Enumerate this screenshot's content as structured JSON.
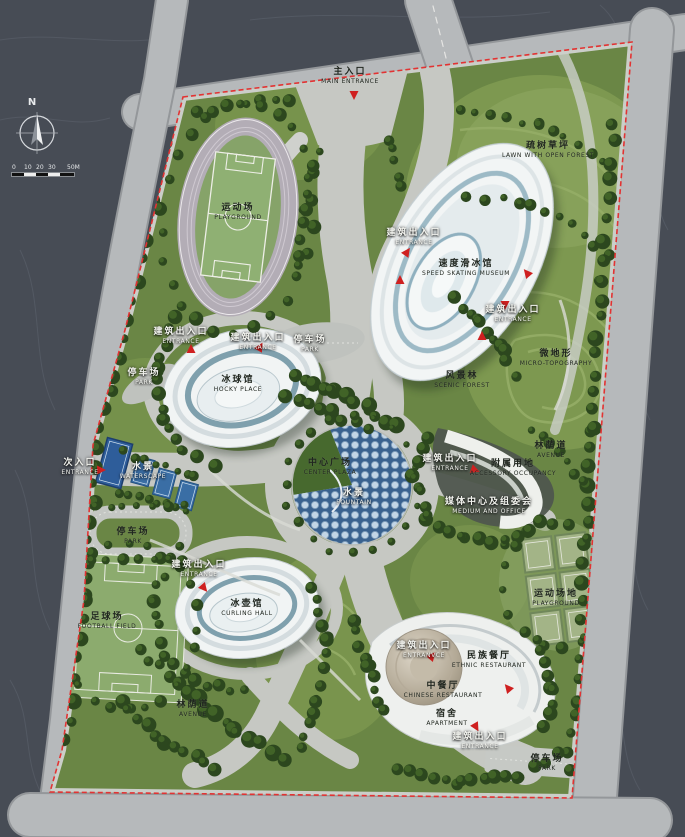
{
  "compass": {
    "north_label": "N"
  },
  "scale_bar": {
    "ticks": [
      "0",
      "10",
      "20",
      "30",
      "50M"
    ],
    "tick_offsets": [
      0,
      12,
      24,
      36,
      55
    ]
  },
  "colors": {
    "background": "#474c55",
    "road_grey": "#b6b9bb",
    "site_green": "#6a8645",
    "tree_dark": "#2c471e",
    "plaza_grey": "#c6c8c3",
    "building_white": "#f2f5f5",
    "water_blue": "#3a628f",
    "boundary_red": "#e23333",
    "marker_red": "#cf2020"
  },
  "labels": [
    {
      "id": "main-entrance",
      "zh": "主入口",
      "en": "MAIN ENTRANCE",
      "x": 350,
      "y": 76,
      "tone": "dark"
    },
    {
      "id": "stadium-playground",
      "zh": "运动场",
      "en": "PLAYGROUND",
      "x": 238,
      "y": 212,
      "tone": "dark"
    },
    {
      "id": "lawn-open-forest",
      "zh": "疏树草坪",
      "en": "LAWN WITH OPEN FOREST",
      "x": 548,
      "y": 150,
      "tone": "dark"
    },
    {
      "id": "entrance-skating-w",
      "zh": "建筑出入口",
      "en": "ENTRANCE",
      "x": 414,
      "y": 237,
      "tone": "light"
    },
    {
      "id": "speed-skating-museum",
      "zh": "速度滑冰馆",
      "en": "SPEED SKATING MUSEUM",
      "x": 466,
      "y": 268,
      "tone": "dark"
    },
    {
      "id": "entrance-skating-e",
      "zh": "建筑出入口",
      "en": "ENTRANCE",
      "x": 513,
      "y": 314,
      "tone": "light"
    },
    {
      "id": "micro-topography",
      "zh": "微地形",
      "en": "MICRO-TOPOGRAPHY",
      "x": 556,
      "y": 358,
      "tone": "dark"
    },
    {
      "id": "entrance-hockey-w",
      "zh": "建筑出入口",
      "en": "ENTRANCE",
      "x": 181,
      "y": 336,
      "tone": "light"
    },
    {
      "id": "entrance-hockey-n",
      "zh": "建筑出入口",
      "en": "ENTRANCE",
      "x": 258,
      "y": 342,
      "tone": "light"
    },
    {
      "id": "park-hockey",
      "zh": "停车场",
      "en": "PARK",
      "x": 310,
      "y": 344,
      "tone": "light"
    },
    {
      "id": "park-west",
      "zh": "停车场",
      "en": "PARK",
      "x": 144,
      "y": 377,
      "tone": "light"
    },
    {
      "id": "hockey-place",
      "zh": "冰球馆",
      "en": "HOCKY PLACE",
      "x": 238,
      "y": 384,
      "tone": "dark"
    },
    {
      "id": "scenic-forest",
      "zh": "风景林",
      "en": "SCENIC FOREST",
      "x": 462,
      "y": 380,
      "tone": "dark"
    },
    {
      "id": "secondary-entrance",
      "zh": "次入口",
      "en": "ENTRANCE",
      "x": 80,
      "y": 467,
      "tone": "light"
    },
    {
      "id": "waterscape-courts",
      "zh": "水景",
      "en": "WATERSCAPE",
      "x": 143,
      "y": 471,
      "tone": "light"
    },
    {
      "id": "center-plaza",
      "zh": "中心广场",
      "en": "CENTER PLAZA",
      "x": 330,
      "y": 467,
      "tone": "dark"
    },
    {
      "id": "plaza-waterscape",
      "zh": "水景",
      "en": "FOUNTAIN",
      "x": 354,
      "y": 497,
      "tone": "light"
    },
    {
      "id": "avenue-east",
      "zh": "林荫道",
      "en": "AVENUE",
      "x": 551,
      "y": 450,
      "tone": "dark"
    },
    {
      "id": "entrance-media",
      "zh": "建筑出入口",
      "en": "ENTRANCE",
      "x": 450,
      "y": 463,
      "tone": "light"
    },
    {
      "id": "accessory-occupancy",
      "zh": "附属用地",
      "en": "ACCESSORY OCCUPANCY",
      "x": 513,
      "y": 468,
      "tone": "dark"
    },
    {
      "id": "media-office",
      "zh": "媒体中心及组委会",
      "en": "MEDIUM AND OFFICE",
      "x": 489,
      "y": 506,
      "tone": "light"
    },
    {
      "id": "park-southwest",
      "zh": "停车场",
      "en": "PARK",
      "x": 133,
      "y": 536,
      "tone": "dark"
    },
    {
      "id": "tennis-playground",
      "zh": "运动场地",
      "en": "PLAYGROUND",
      "x": 556,
      "y": 598,
      "tone": "dark"
    },
    {
      "id": "entrance-curling",
      "zh": "建筑出入口",
      "en": "ENTRANCE",
      "x": 199,
      "y": 569,
      "tone": "light"
    },
    {
      "id": "curling-hall",
      "zh": "冰壶馆",
      "en": "CURLING HALL",
      "x": 247,
      "y": 608,
      "tone": "dark"
    },
    {
      "id": "football-field",
      "zh": "足球场",
      "en": "FOOTBALL FIELD",
      "x": 107,
      "y": 621,
      "tone": "dark"
    },
    {
      "id": "entrance-rest-nw",
      "zh": "建筑出入口",
      "en": "ENTRANVCE",
      "x": 424,
      "y": 650,
      "tone": "light"
    },
    {
      "id": "ethnic-restaurant",
      "zh": "民族餐厅",
      "en": "ETHNIC RESTAURANT",
      "x": 489,
      "y": 660,
      "tone": "dark"
    },
    {
      "id": "chinese-restaurant",
      "zh": "中餐厅",
      "en": "CHINESE RESTAURANT",
      "x": 443,
      "y": 690,
      "tone": "dark"
    },
    {
      "id": "apartment",
      "zh": "宿舍",
      "en": "APARTMENT",
      "x": 447,
      "y": 718,
      "tone": "dark"
    },
    {
      "id": "avenue-southwest",
      "zh": "林荫道",
      "en": "AVENUE",
      "x": 193,
      "y": 709,
      "tone": "dark"
    },
    {
      "id": "entrance-southeast",
      "zh": "建筑出入口",
      "en": "ENTRANCE",
      "x": 480,
      "y": 741,
      "tone": "light"
    },
    {
      "id": "park-southeast",
      "zh": "停车场",
      "en": "PARK",
      "x": 547,
      "y": 763,
      "tone": "dark"
    }
  ],
  "markers": [
    {
      "x": 354,
      "y": 95,
      "rot": 180
    },
    {
      "x": 101,
      "y": 470,
      "rot": 90
    },
    {
      "x": 407,
      "y": 252,
      "rot": 35
    },
    {
      "x": 400,
      "y": 280,
      "rot": 0
    },
    {
      "x": 527,
      "y": 273,
      "rot": -40
    },
    {
      "x": 505,
      "y": 305,
      "rot": 180
    },
    {
      "x": 482,
      "y": 336,
      "rot": 0
    },
    {
      "x": 191,
      "y": 349,
      "rot": 0
    },
    {
      "x": 260,
      "y": 347,
      "rot": 30
    },
    {
      "x": 204,
      "y": 588,
      "rot": 140
    },
    {
      "x": 475,
      "y": 470,
      "rot": 110
    },
    {
      "x": 432,
      "y": 656,
      "rot": 40
    },
    {
      "x": 508,
      "y": 688,
      "rot": -40
    },
    {
      "x": 476,
      "y": 727,
      "rot": 150
    }
  ]
}
